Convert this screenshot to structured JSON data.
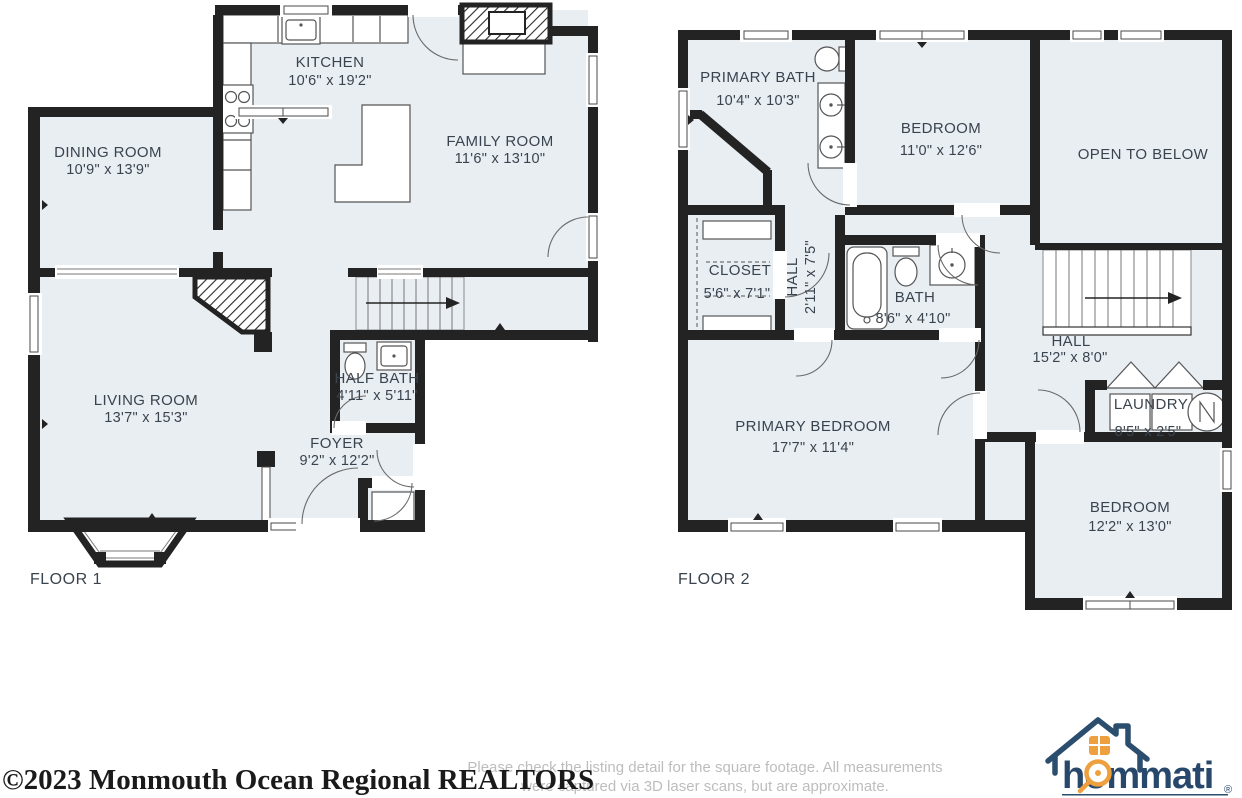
{
  "floor1": {
    "label": "FLOOR 1",
    "rooms": {
      "dining": {
        "name": "DINING ROOM",
        "dims": "10'9\" x 13'9\""
      },
      "kitchen": {
        "name": "KITCHEN",
        "dims": "10'6\" x 19'2\""
      },
      "family": {
        "name": "FAMILY ROOM",
        "dims": "11'6\" x 13'10\""
      },
      "living": {
        "name": "LIVING ROOM",
        "dims": "13'7\" x 15'3\""
      },
      "half_bath": {
        "name": "HALF BATH",
        "dims": "4'11\" x 5'11\""
      },
      "foyer": {
        "name": "FOYER",
        "dims": "9'2\" x 12'2\""
      }
    }
  },
  "floor2": {
    "label": "FLOOR 2",
    "rooms": {
      "primary_bath": {
        "name": "PRIMARY BATH",
        "dims": "10'4\" x 10'3\""
      },
      "bedroom_top": {
        "name": "BEDROOM",
        "dims": "11'0\" x 12'6\""
      },
      "open_below": {
        "name": "OPEN TO BELOW",
        "dims": ""
      },
      "closet": {
        "name": "CLOSET",
        "dims": "5'6\" x 7'1\""
      },
      "hall_small": {
        "name": "HALL",
        "dims": "2'11\" x 7'5\""
      },
      "bath": {
        "name": "BATH",
        "dims": "8'6\" x 4'10\""
      },
      "hall_big": {
        "name": "HALL",
        "dims": "15'2\" x 8'0\""
      },
      "primary_bedroom": {
        "name": "PRIMARY BEDROOM",
        "dims": "17'7\" x 11'4\""
      },
      "laundry": {
        "name": "LAUNDRY",
        "dims": "8'5\" x 2'5\""
      },
      "bedroom_bottom": {
        "name": "BEDROOM",
        "dims": "12'2\" x 13'0\""
      }
    }
  },
  "footer": {
    "watermark": "©2023 Monmouth Ocean Regional REALTORS",
    "disclaimer_line1": "Please check the listing detail for the square footage. All measurements",
    "disclaimer_line2": "were captured via 3D laser scans, but are approximate.",
    "logo_text": "hommati",
    "logo_reg": "®"
  },
  "colors": {
    "floor_fill": "#e9eef3",
    "wall": "#232323",
    "label_text": "#3a444e",
    "logo_navy": "#27486b",
    "logo_orange": "#eda03d"
  }
}
